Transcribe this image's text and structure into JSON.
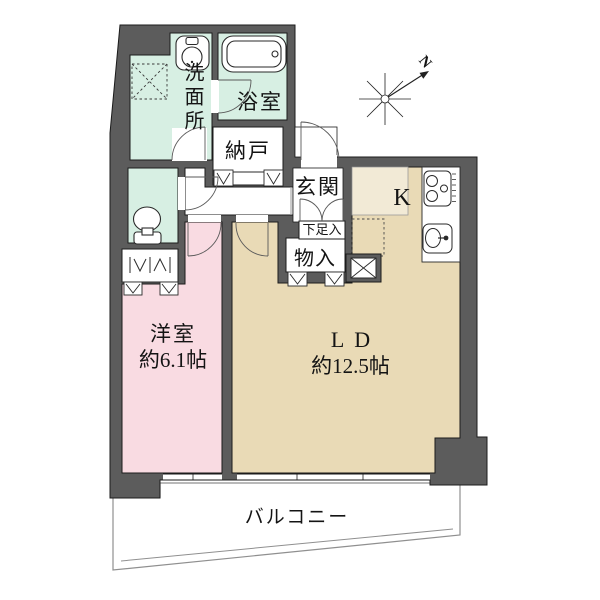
{
  "floorplan": {
    "rooms": {
      "washroom": "洗面所",
      "bathroom": "浴室",
      "storage": "納戸",
      "entrance": "玄関",
      "shoe_cabinet": "下足入",
      "closet": "物入",
      "kitchen": "K",
      "western_room": {
        "name": "洋室",
        "size": "約6.1帖"
      },
      "living_dining": {
        "name": "LD",
        "size": "約12.5帖"
      },
      "balcony": "バルコニー"
    },
    "compass": {
      "north": "N"
    },
    "colors": {
      "wall": "#5c5c5c",
      "mint": "#d7efe3",
      "pink": "#f9dbe2",
      "beige": "#e9dab6",
      "cream": "#f2ead6",
      "white": "#ffffff"
    }
  }
}
